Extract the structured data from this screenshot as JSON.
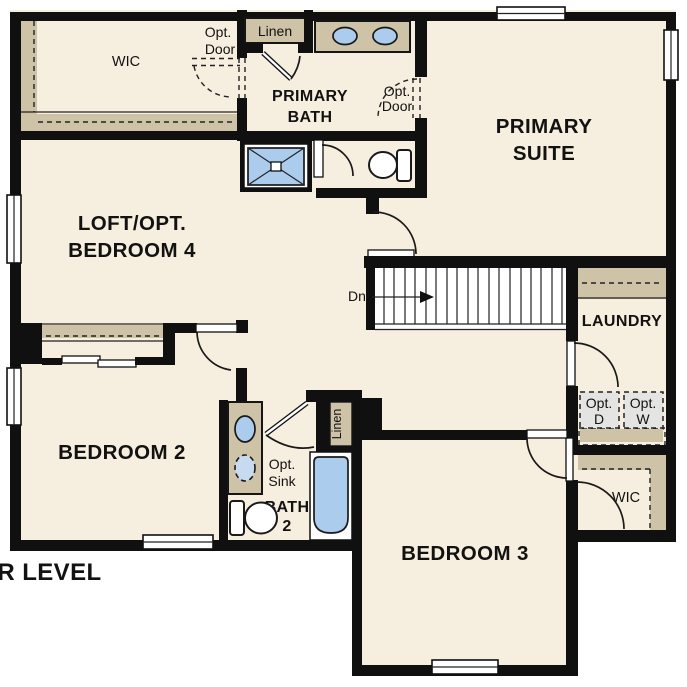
{
  "title": {
    "plan_label": "UPPER LEVEL"
  },
  "rooms": {
    "primary_wic": "WIC",
    "primary_linen": "Linen",
    "primary_bath": [
      "PRIMARY",
      "BATH"
    ],
    "primary_suite": [
      "PRIMARY",
      "SUITE"
    ],
    "loft": [
      "LOFT/OPT.",
      "BEDROOM 4"
    ],
    "laundry": "LAUNDRY",
    "bedroom2": "BEDROOM 2",
    "bath2": [
      "BATH",
      "2"
    ],
    "bath2_linen": "Linen",
    "bedroom3": "BEDROOM 3",
    "bedroom3_wic": "WIC"
  },
  "annotations": {
    "opt_door_wic": [
      "Opt.",
      "Door"
    ],
    "opt_door_suite": [
      "Opt.",
      "Door"
    ],
    "opt_sink": [
      "Opt.",
      "Sink"
    ],
    "opt_dryer": [
      "Opt.",
      "D"
    ],
    "opt_washer": [
      "Opt.",
      "W"
    ],
    "stairs_down": "Dn"
  },
  "colors": {
    "floor": "#f6eede",
    "wall": "#101010",
    "tan": "#cfc3a7",
    "blue": "#abccec",
    "blue_light": "#c8daf0",
    "gray": "#e4e4e2"
  }
}
